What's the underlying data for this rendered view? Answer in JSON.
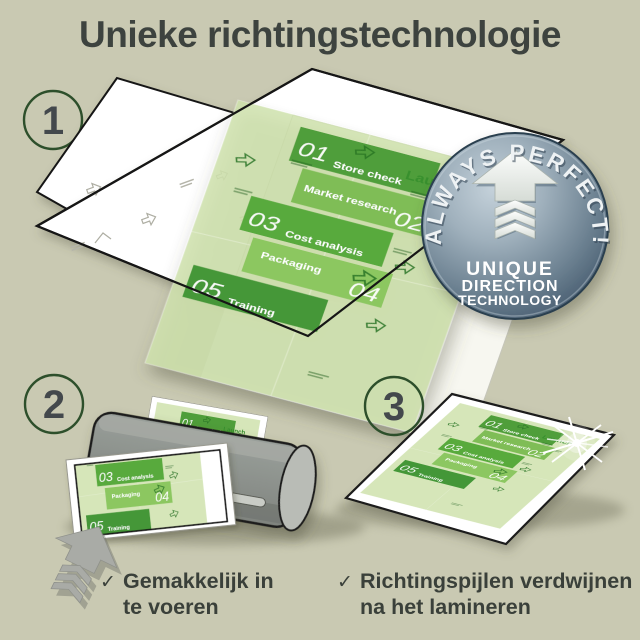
{
  "title": "Unieke richtingstechnologie",
  "step_numbers": [
    "1",
    "2",
    "3"
  ],
  "badge": {
    "arc_text": "ALWAYS PERFECT!",
    "line1": "UNIQUE",
    "line2": "DIRECTION",
    "line3": "TECHNOLOGY"
  },
  "document": {
    "launch": "Launch",
    "items": [
      {
        "num": "01",
        "label": "Store check"
      },
      {
        "num": "02",
        "label": "Market research"
      },
      {
        "num": "03",
        "label": "Cost analysis"
      },
      {
        "num": "04",
        "label": "Packaging"
      },
      {
        "num": "05",
        "label": "Training"
      }
    ]
  },
  "captions": {
    "feed": {
      "check": "✓",
      "line1": "Gemakkelijk in",
      "line2": "te voeren"
    },
    "result": {
      "check": "✓",
      "line1": "Richtingspijlen verdwijnen",
      "line2": "na het lamineren"
    }
  },
  "colors": {
    "background": "#c9c9b2",
    "accent_green": "#58aa3c",
    "badge_blue": "#6d8494",
    "ink": "#3d433f"
  }
}
